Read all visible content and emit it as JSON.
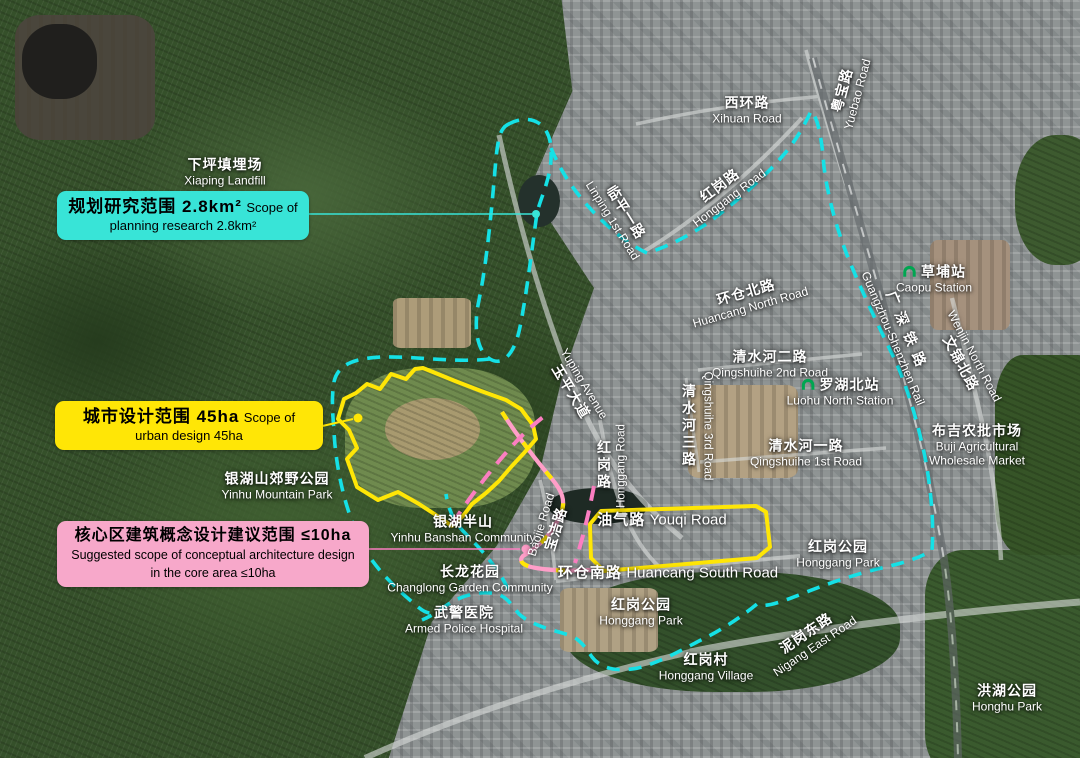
{
  "colors": {
    "planning-accent": "#38e4d7",
    "urban-accent": "#ffe606",
    "core-accent": "#f7a8ca",
    "core-line": "#fb7ec1",
    "rail-line": "#ff9ec8",
    "boundary-cyan": "#15e1e6",
    "metro-green": "#00a651"
  },
  "legend_boxes": {
    "planning": {
      "zh": "规划研究范围  2.8km²",
      "en": "Scope of planning research  2.8km²"
    },
    "urban": {
      "zh": "城市设计范围  45ha",
      "en": "Scope of urban design  45ha"
    },
    "core": {
      "zh": "核心区建筑概念设计建议范围  ≤10ha",
      "en_line1": "Suggested scope of conceptual architecture design",
      "en_line2": "in the core area  ≤10ha"
    }
  },
  "map_labels": [
    {
      "id": "xiaping-landfill",
      "zh": "下坪填埋场",
      "en": "Xiaping Landfill",
      "x": 225,
      "y": 172,
      "rot": 0
    },
    {
      "id": "xihuan-road",
      "zh": "西环路",
      "en": "Xihuan Road",
      "x": 747,
      "y": 110,
      "rot": 0
    },
    {
      "id": "yuebao-road",
      "zh": "粤宝路",
      "en": "Yuebao Road",
      "x": 849,
      "y": 92,
      "rot": -75
    },
    {
      "id": "linping-1st-road",
      "zh": "临平一路",
      "en": "Linping 1st Road",
      "x": 620,
      "y": 216,
      "rot": 58
    },
    {
      "id": "honggang-road-upper",
      "zh": "红岗路",
      "en": "Honggang Road",
      "x": 724,
      "y": 191,
      "rot": -37
    },
    {
      "id": "caopu-station",
      "zh": "草埔站",
      "en": "Caopu Station",
      "x": 934,
      "y": 279,
      "rot": 0,
      "icon": "metro"
    },
    {
      "id": "guangshen-rail",
      "zh": "广深铁路",
      "en": "Guangzhou-Shenzhen Rail",
      "x": 901,
      "y": 335,
      "rot": 67,
      "spaced": true
    },
    {
      "id": "huancang-north-road",
      "zh": "环仓北路",
      "en": "Huancang North Road",
      "x": 748,
      "y": 299,
      "rot": -16
    },
    {
      "id": "qingshuihe-2nd-road",
      "zh": "清水河二路",
      "en": "Qingshuihe 2nd Road",
      "x": 770,
      "y": 364,
      "rot": 0
    },
    {
      "id": "luohu-north-station",
      "zh": "罗湖北站",
      "en": "Luohu North Station",
      "x": 840,
      "y": 392,
      "rot": 0,
      "icon": "metro"
    },
    {
      "id": "qingshuihe-3rd-road",
      "zh": "清水河三路",
      "en": "Qingshuihe 3rd Road",
      "x": 697,
      "y": 426,
      "rot": 0,
      "vertical": true
    },
    {
      "id": "qingshuihe-1st-road",
      "zh": "清水河一路",
      "en": "Qingshuihe 1st Road",
      "x": 806,
      "y": 453,
      "rot": 0
    },
    {
      "id": "buji-agricultural-market",
      "zh": "布吉农批市场",
      "en": "Buji Agricultural",
      "en2": "Wholesale Market",
      "x": 977,
      "y": 445,
      "rot": 0
    },
    {
      "id": "wenjin-north-road",
      "zh": "文锦北路",
      "en": "Wenjin North Road",
      "x": 967,
      "y": 360,
      "rot": 62,
      "en_first": true
    },
    {
      "id": "yuping-avenue",
      "zh": "玉平大道",
      "en": "Yuping Avenue",
      "x": 577,
      "y": 388,
      "rot": 59,
      "en_first": true
    },
    {
      "id": "honggang-road-vertical",
      "zh": "红岗路",
      "en": "Honggang Road",
      "x": 612,
      "y": 466,
      "rot": 0,
      "vertical": true,
      "en_up": true
    },
    {
      "id": "yinhu-mountain-park",
      "zh": "银湖山郊野公园",
      "en": "Yinhu Mountain Park",
      "x": 277,
      "y": 486,
      "rot": 0
    },
    {
      "id": "yinhu-banshan-community",
      "zh": "银湖半山",
      "en": "Yinhu Banshan Community",
      "x": 463,
      "y": 529,
      "rot": 0
    },
    {
      "id": "baojie-road",
      "zh": "宝洁路",
      "en": "Baojie Road",
      "x": 549,
      "y": 527,
      "rot": -73,
      "en_first": true
    },
    {
      "id": "youqi-road",
      "zh": "油气路",
      "en": "Youqi Road",
      "x": 662,
      "y": 521,
      "rot": 0,
      "inline": true
    },
    {
      "id": "huancang-south-road",
      "zh": "环仓南路",
      "en": "Huancang South Road",
      "x": 668,
      "y": 574,
      "rot": 0,
      "inline": true
    },
    {
      "id": "changlong-garden-community",
      "zh": "长龙花园",
      "en": "Changlong Garden Community",
      "x": 470,
      "y": 579,
      "rot": 0
    },
    {
      "id": "armed-police-hospital",
      "zh": "武警医院",
      "en": "Armed Police Hospital",
      "x": 464,
      "y": 620,
      "rot": 0
    },
    {
      "id": "honggang-park-center",
      "zh": "红岗公园",
      "en": "Honggang Park",
      "x": 641,
      "y": 612,
      "rot": 0
    },
    {
      "id": "honggang-park-east",
      "zh": "红岗公园",
      "en": "Honggang Park",
      "x": 838,
      "y": 554,
      "rot": 0
    },
    {
      "id": "honggang-village",
      "zh": "红岗村",
      "en": "Honggang Village",
      "x": 706,
      "y": 667,
      "rot": 0
    },
    {
      "id": "nigang-east-road",
      "zh": "泥岗东路",
      "en": "Nigang East Road",
      "x": 810,
      "y": 639,
      "rot": -34
    },
    {
      "id": "honghu-park",
      "zh": "洪湖公园",
      "en": "Honghu Park",
      "x": 1007,
      "y": 698,
      "rot": 0
    }
  ]
}
